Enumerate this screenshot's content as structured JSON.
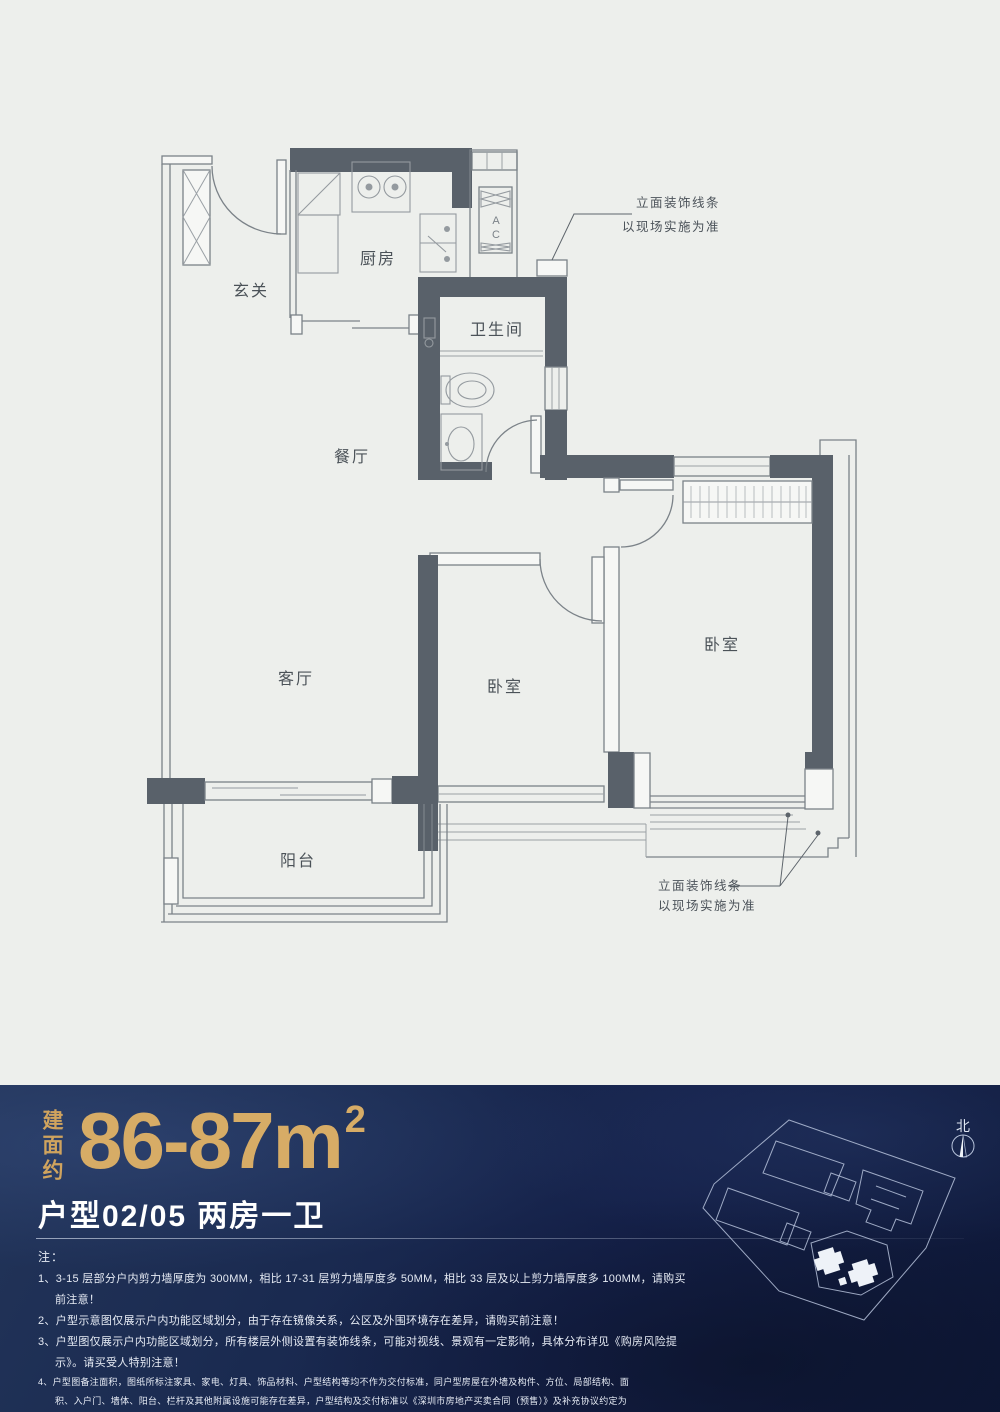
{
  "plan": {
    "room_labels": {
      "entry": "玄关",
      "kitchen": "厨房",
      "bathroom": "卫生间",
      "dining": "餐厅",
      "living": "客厅",
      "bedroom_middle": "卧室",
      "bedroom_right": "卧室",
      "balcony": "阳台"
    },
    "ac_unit": {
      "letter1": "A",
      "letter2": "C"
    },
    "annotations": {
      "top": {
        "line1": "立面装饰线条",
        "line2": "以现场实施为准"
      },
      "bottom": {
        "line1": "立面装饰线条",
        "line2": "以现场实施为准"
      }
    }
  },
  "panel": {
    "area": {
      "prefix": "建面约",
      "value": "86-87m",
      "superscript": "2"
    },
    "unit_type": "户型02/05  两房一卫",
    "notes_label": "注：",
    "notes": [
      "1、3-15 层部分户内剪力墙厚度为 300MM，相比 17-31 层剪力墙厚度多 50MM，相比 33 层及以上剪力墙厚度多 100MM，请购买前注意！",
      "2、户型示意图仅展示户内功能区域划分，由于存在镜像关系，公区及外围环境存在差异，请购买前注意！",
      "3、户型图仅展示户内功能区域划分，所有楼层外侧设置有装饰线条，可能对视线、景观有一定影响，具体分布详见《购房风险提示》。请买受人特别注意！",
      "4、户型图备注面积，图纸所标注家具、家电、灯具、饰品材料、户型结构等均不作为交付标准，同户型房屋在外墙及构件、方位、局部结构、面积、入户门、墙体、阳台、栏杆及其他附属设施可能存在差异，户型结构及交付标准以《深圳市房地产买卖合同（预售）》及补充协议约定为准。"
    ],
    "sitemap": {
      "north_label": "北"
    }
  },
  "colors": {
    "wall": "#59616a",
    "plan_background": "#edefec",
    "panel_navy": "#16224a",
    "gold": "#d7ac66",
    "thin_line": "#7b8288"
  }
}
